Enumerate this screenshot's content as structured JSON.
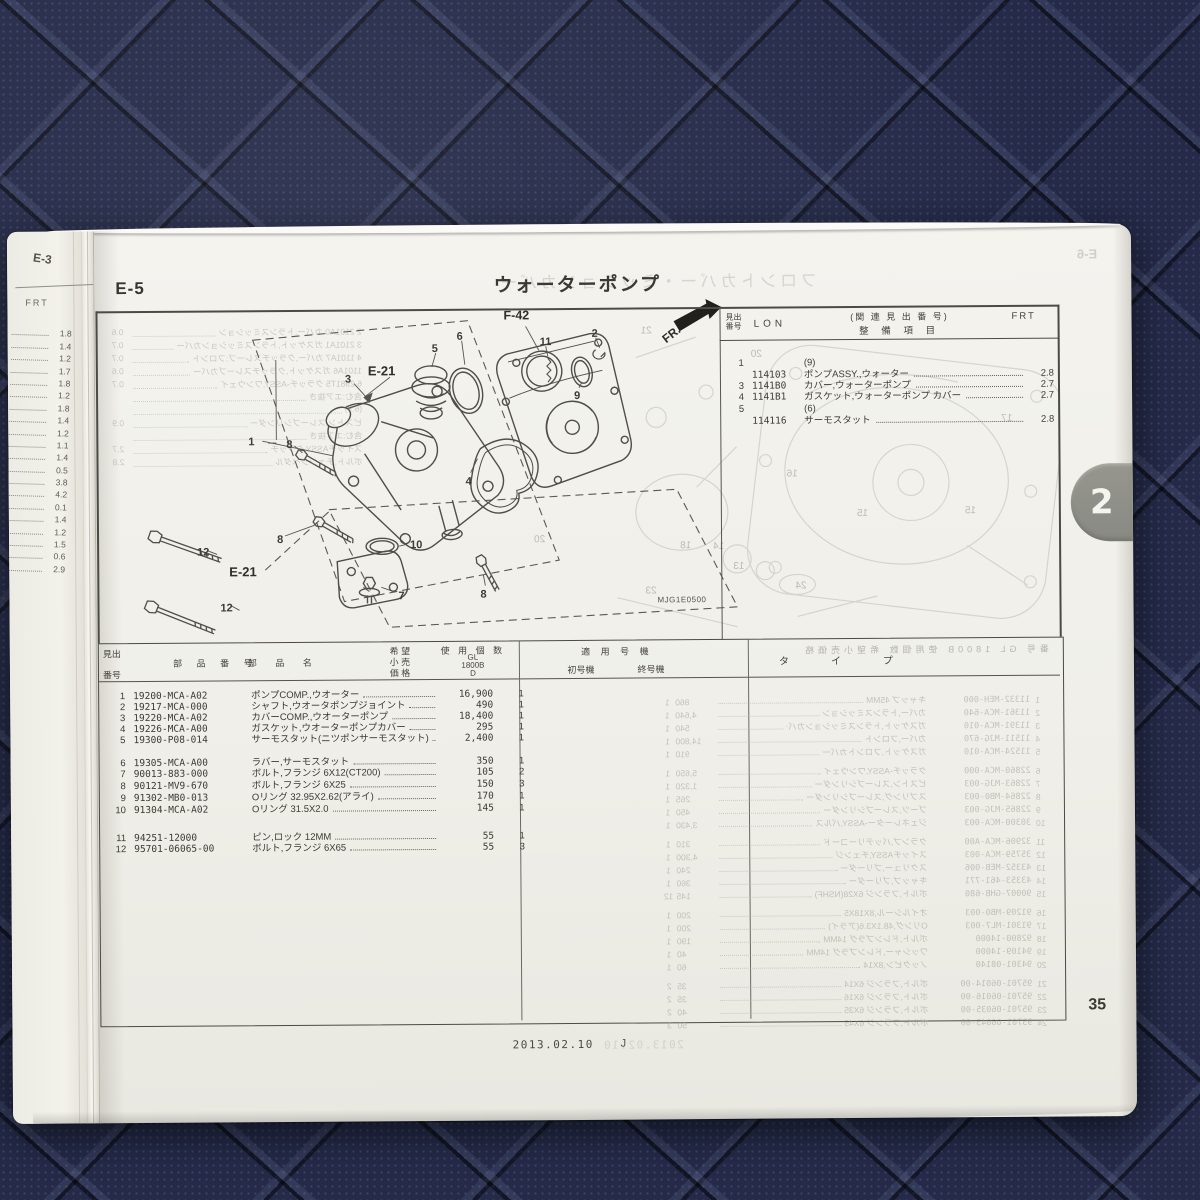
{
  "page": {
    "section": "E-5",
    "title": "ウォーターポンプ",
    "page_number": "35",
    "footer_date": "2013.02.10",
    "footer_code": "J",
    "tab": "2"
  },
  "prev_page": {
    "label": "E-3",
    "frt": "FRT",
    "values": [
      "1.8",
      "1.4",
      "1.2",
      "1.7",
      "1.8",
      "1.2",
      "1.8",
      "1.4",
      "1.2",
      "1.1",
      "1.4",
      "0.5",
      "3.8",
      "4.2",
      "0.1",
      "1.4",
      "1.2",
      "1.5",
      "0.6",
      "2.9"
    ]
  },
  "related": {
    "header": {
      "hidashi": "見出",
      "bango": "番号",
      "lon": "LON",
      "rel": "(関 連 見 出 番 号)",
      "item": "整  備  項  目",
      "frt": "FRT"
    },
    "rows": [
      {
        "no": "1",
        "lon": "",
        "desc": "(9)",
        "frt": "",
        "cls": "plain",
        "y": 50
      },
      {
        "no": "",
        "lon": "114103",
        "desc": "ポンプASSY.,ウォーター",
        "frt": "2.8",
        "cls": "",
        "y": 62
      },
      {
        "no": "3",
        "lon": "1141B0",
        "desc": "カバー,ウォーターポンプ",
        "frt": "2.7",
        "cls": "",
        "y": 73
      },
      {
        "no": "4",
        "lon": "1141B1",
        "desc": "ガスケット,ウォーターポンプ カバー",
        "frt": "2.7",
        "cls": "",
        "y": 84
      },
      {
        "no": "5",
        "lon": "",
        "desc": "(6)",
        "frt": "",
        "cls": "plain",
        "y": 96
      },
      {
        "no": "",
        "lon": "114116",
        "desc": "サーモスタット",
        "frt": "2.8",
        "cls": "",
        "y": 108
      }
    ]
  },
  "diagram": {
    "label_f42": "F-42",
    "label_e21_upper": "E-21",
    "label_e21_lower": "E-21",
    "label_fr": "FR.",
    "code": "MJG1E0500",
    "callouts": [
      {
        "n": "1",
        "x": 152,
        "y": 136
      },
      {
        "n": "3",
        "x": 249,
        "y": 74
      },
      {
        "n": "5",
        "x": 336,
        "y": 44
      },
      {
        "n": "6",
        "x": 361,
        "y": 32
      },
      {
        "n": "11",
        "x": 444,
        "y": 38
      },
      {
        "n": "2",
        "x": 496,
        "y": 30
      },
      {
        "n": "9",
        "x": 478,
        "y": 92
      },
      {
        "n": "4",
        "x": 369,
        "y": 177
      },
      {
        "n": "8",
        "x": 190,
        "y": 139
      },
      {
        "n": "8",
        "x": 180,
        "y": 234
      },
      {
        "n": "8",
        "x": 383,
        "y": 290
      },
      {
        "n": "10",
        "x": 313,
        "y": 240
      },
      {
        "n": "7",
        "x": 301,
        "y": 291
      },
      {
        "n": "12",
        "x": 100,
        "y": 246
      },
      {
        "n": "12",
        "x": 123,
        "y": 302
      }
    ],
    "ghost_numbers": [
      {
        "n": "21",
        "x": 545,
        "y": 28
      },
      {
        "n": "20",
        "x": 655,
        "y": 52
      },
      {
        "n": "17",
        "x": 905,
        "y": 118
      },
      {
        "n": "15",
        "x": 760,
        "y": 212
      },
      {
        "n": "15",
        "x": 868,
        "y": 210
      },
      {
        "n": "16",
        "x": 690,
        "y": 172
      },
      {
        "n": "13",
        "x": 636,
        "y": 264
      },
      {
        "n": "14",
        "x": 616,
        "y": 244
      },
      {
        "n": "24",
        "x": 698,
        "y": 284
      },
      {
        "n": "23",
        "x": 548,
        "y": 288
      },
      {
        "n": "20",
        "x": 437,
        "y": 236
      },
      {
        "n": "18",
        "x": 583,
        "y": 243
      }
    ],
    "ghost_upper_lines": [
      {
        "t": "2 2101A0  カバー,トランスミッション",
        "v": "0.6"
      },
      {
        "t": "3 2101A1  ガスケット,トランスミッションカバー",
        "v": "0.7"
      },
      {
        "t": "4 1101A7  カバー,クラッチスレーブ:フロント",
        "v": "0.7"
      },
      {
        "t": "1101A6  ガスケット,クラッチスレーブカバー",
        "v": "0.6"
      },
      {
        "t": "6 2981T5  クラッチ-ASSY,ワンウェイ",
        "v": "0.7"
      },
      {
        "t": "含む:エア抜き",
        "v": ""
      },
      {
        "t": "(6.9)",
        "v": ""
      },
      {
        "t": "ピストン,スレーブシリンダー",
        "v": "0.9"
      },
      {
        "t": "含む:エア抜き",
        "v": ""
      },
      {
        "t": "スイッチASSY,クラッチ",
        "v": "2.7"
      },
      {
        "t": "ボルト,チェンジペダル",
        "v": "2.8"
      }
    ]
  },
  "parts": {
    "header": {
      "hidashi": "見出",
      "bango": "番号",
      "part_no": "部 品 番 号",
      "part_name": "部  品  名",
      "kibo": "希 望",
      "kouri": "小 売",
      "kakaku": "価 格",
      "shiyo": "使 用 個 数",
      "gl": "GL",
      "model": "1800B",
      "d": "D",
      "tekiyo": "適  用  号  機",
      "shogoki": "初号機",
      "shugoki": "終号機",
      "type": "タ　イ　プ"
    },
    "rows": [
      {
        "no": "1",
        "pn": "19200-MCA-A02",
        "name": "ポンプCOMP.,ウオーター",
        "price": "16,900",
        "qty": "1",
        "y": 46
      },
      {
        "no": "2",
        "pn": "19217-MCA-000",
        "name": "シャフト,ウオータポンプジョイント",
        "price": "490",
        "qty": "1",
        "y": 57
      },
      {
        "no": "3",
        "pn": "19220-MCA-A02",
        "name": "カバーCOMP.,ウオーターポンプ",
        "price": "18,400",
        "qty": "1",
        "y": 68
      },
      {
        "no": "4",
        "pn": "19226-MCA-A00",
        "name": "ガスケット,ウオーターポンプカバー",
        "price": "295",
        "qty": "1",
        "y": 79
      },
      {
        "no": "5",
        "pn": "19300-P08-014",
        "name": "サーモスタット(ニツポンサーモスタット)",
        "price": "2,400",
        "qty": "1",
        "y": 90
      },
      {
        "no": "6",
        "pn": "19305-MCA-A00",
        "name": "ラバー,サーモスタット",
        "price": "350",
        "qty": "1",
        "y": 113
      },
      {
        "no": "7",
        "pn": "90013-883-000",
        "name": "ボルト,フランジ 6X12(CT200)",
        "price": "105",
        "qty": "2",
        "y": 124
      },
      {
        "no": "8",
        "pn": "90121-MV9-670",
        "name": "ボルト,フランジ 6X25",
        "price": "150",
        "qty": "3",
        "y": 136
      },
      {
        "no": "9",
        "pn": "91302-MB0-013",
        "name": "Oリング 32.95X2.62(アライ)",
        "price": "170",
        "qty": "1",
        "y": 148
      },
      {
        "no": "10",
        "pn": "91304-MCA-A02",
        "name": "Oリング 31.5X2.0",
        "price": "145",
        "qty": "1",
        "y": 160
      },
      {
        "no": "11",
        "pn": "94251-12000",
        "name": "ピン,ロック 12MM",
        "price": "55",
        "qty": "1",
        "y": 188
      },
      {
        "no": "12",
        "pn": "95701-06065-00",
        "name": "ボルト,フランジ 6X65",
        "price": "55",
        "qty": "3",
        "y": 199
      }
    ]
  },
  "showthrough": {
    "title": "フロントカバー・ミッションカバー",
    "page_label": "E-6",
    "footer_date": "2013.02.10",
    "parts_header": "番号  GL 1800B  使用個数  希望小売価格",
    "rows": [
      {
        "no": "1",
        "pn": "11332-MEH-000",
        "name": "キャップ 45MM",
        "price": "860",
        "qty": "1",
        "y": 30
      },
      {
        "no": "2",
        "pn": "11361-MCA-640",
        "name": "カバー,トランスミッション",
        "price": "4,640",
        "qty": "1",
        "y": 43
      },
      {
        "no": "3",
        "pn": "11391-MCA-010",
        "name": "ガスケット,トランスミッションカバー",
        "price": "540",
        "qty": "1",
        "y": 56
      },
      {
        "no": "4",
        "pn": "11511-MJG-670",
        "name": "カバー,フロント",
        "price": "14,800",
        "qty": "1",
        "y": 69
      },
      {
        "no": "5",
        "pn": "11524-MCA-010",
        "name": "ガスケット,フロントカバー",
        "price": "910",
        "qty": "1",
        "y": 82
      },
      {
        "no": "6",
        "pn": "22860-MCA-000",
        "name": "クラッチ-ASSY,ワンウェイ",
        "price": "5,650",
        "qty": "1",
        "y": 101
      },
      {
        "no": "7",
        "pn": "22863-MJG-003",
        "name": "ピストン,スレーブシリンダー",
        "price": "1,320",
        "qty": "1",
        "y": 114
      },
      {
        "no": "8",
        "pn": "22864-MB0-003",
        "name": "スプリング,スレーブシリンダー",
        "price": "265",
        "qty": "1",
        "y": 127
      },
      {
        "no": "9",
        "pn": "22865-MJG-003",
        "name": "ブーツ,スレーブシリンダー",
        "price": "450",
        "qty": "1",
        "y": 140
      },
      {
        "no": "10",
        "pn": "30300-MCA-003",
        "name": "ジェネレーター-ASSY,パルス",
        "price": "3,430",
        "qty": "1",
        "y": 153
      },
      {
        "no": "11",
        "pn": "32906-MCA-A00",
        "name": "クランプ,バッテリーコード",
        "price": "310",
        "qty": "1",
        "y": 172
      },
      {
        "no": "12",
        "pn": "35759-MCA-003",
        "name": "スイッチASSY,チェンジ",
        "price": "4,300",
        "qty": "1",
        "y": 185
      },
      {
        "no": "13",
        "pn": "43352-MEB-006",
        "name": "スクリュー,ブリーダー",
        "price": "240",
        "qty": "1",
        "y": 198
      },
      {
        "no": "14",
        "pn": "43353-461-771",
        "name": "キャップ,ブリーダー",
        "price": "360",
        "qty": "1",
        "y": 211
      },
      {
        "no": "15",
        "pn": "90007-GHB-680",
        "name": "ボルト,フランジ 6X28(NSHF)",
        "price": "145",
        "qty": "12",
        "y": 224
      },
      {
        "no": "16",
        "pn": "91209-MB0-003",
        "name": "オイルシール,8X18X5",
        "price": "200",
        "qty": "1",
        "y": 243
      },
      {
        "no": "17",
        "pn": "91301-ML7-003",
        "name": "Oリング,48.1X3.6(アライ)",
        "price": "200",
        "qty": "1",
        "y": 256
      },
      {
        "no": "18",
        "pn": "92800-14000",
        "name": "ボルト,ドレンプラグ 14MM",
        "price": "190",
        "qty": "1",
        "y": 269
      },
      {
        "no": "19",
        "pn": "94109-14000",
        "name": "ワッシャー,ドレンプラグ 14MM",
        "price": "40",
        "qty": "1",
        "y": 282
      },
      {
        "no": "20",
        "pn": "94301-08140",
        "name": "ノックピン,8X14",
        "price": "60",
        "qty": "1",
        "y": 295
      },
      {
        "no": "21",
        "pn": "95701-06014-00",
        "name": "ボルト,フランジ 6X14",
        "price": "35",
        "qty": "2",
        "y": 314
      },
      {
        "no": "22",
        "pn": "95701-06016-00",
        "name": "ボルト,フランジ 6X16",
        "price": "35",
        "qty": "2",
        "y": 327
      },
      {
        "no": "23",
        "pn": "95701-06035-00",
        "name": "ボルト,フランジ 6X35",
        "price": "40",
        "qty": "2",
        "y": 340
      },
      {
        "no": "24",
        "pn": "95701-06045-00",
        "name": "ボルト,フランジ 6X45",
        "price": "50",
        "qty": "3",
        "y": 353
      }
    ]
  }
}
